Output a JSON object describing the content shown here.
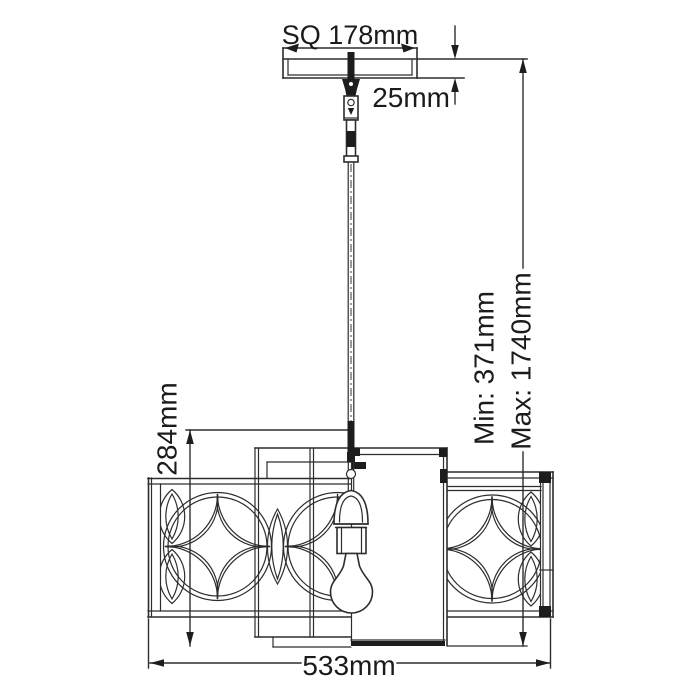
{
  "diagram": {
    "subject": "square-pendant-light-dimension-drawing",
    "labels": {
      "canopy_width": "SQ 178mm",
      "canopy_drop": "25mm",
      "suspension_min": "Min: 371mm",
      "suspension_max": "Max: 1740mm",
      "shade_height": "284mm",
      "overall_width": "533mm"
    },
    "colors": {
      "line": "#2d2d2d",
      "text": "#1b1b1b",
      "background": "#ffffff"
    }
  }
}
